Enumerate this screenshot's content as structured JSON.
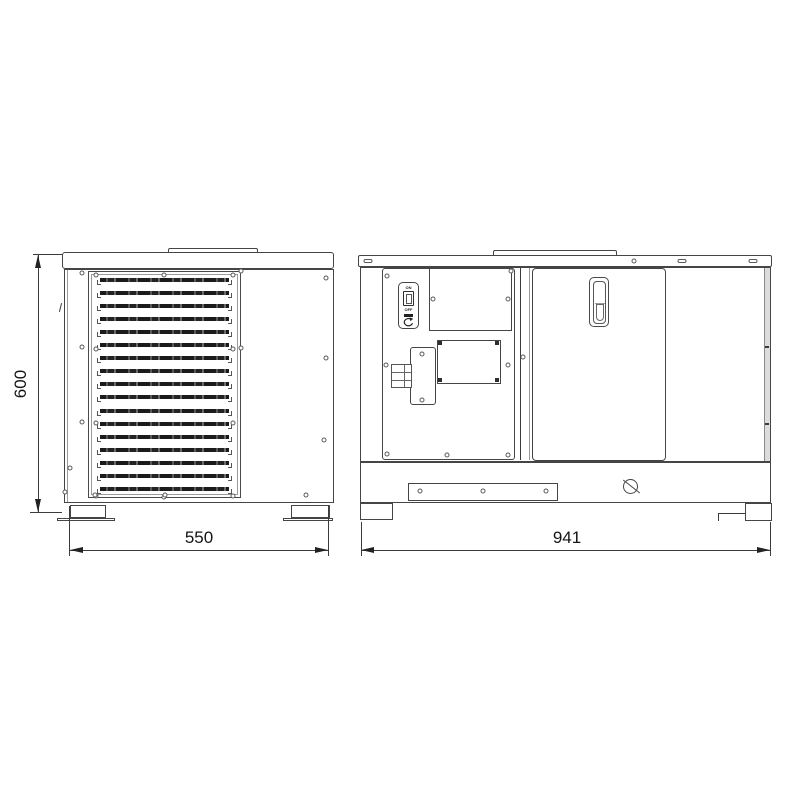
{
  "dimensions": {
    "height_label": "600",
    "front_width_label": "550",
    "side_width_label": "941"
  },
  "power_switch": {
    "on_label": "ON",
    "off_label": "OFF"
  },
  "front_view": {
    "louver_count": 17
  },
  "drawing": {
    "screws": {
      "front_panel": [
        [
          96,
          275
        ],
        [
          96,
          349
        ],
        [
          96,
          423
        ],
        [
          96,
          496
        ],
        [
          233,
          275
        ],
        [
          233,
          349
        ],
        [
          233,
          423
        ],
        [
          233,
          496
        ],
        [
          164,
          275
        ],
        [
          164,
          497
        ]
      ],
      "front_case": [
        [
          82,
          273
        ],
        [
          82,
          347
        ],
        [
          82,
          422
        ],
        [
          70,
          468
        ],
        [
          241,
          271
        ],
        [
          241,
          348
        ],
        [
          326,
          278
        ],
        [
          326,
          358
        ],
        [
          324,
          440
        ],
        [
          306,
          495
        ],
        [
          65,
          492
        ],
        [
          95,
          495
        ],
        [
          165,
          495
        ]
      ],
      "side_view": [
        [
          387,
          276
        ],
        [
          511,
          271
        ],
        [
          386,
          365
        ],
        [
          508,
          365
        ],
        [
          387,
          454
        ],
        [
          447,
          455
        ],
        [
          508,
          455
        ],
        [
          433,
          299
        ],
        [
          508,
          299
        ],
        [
          422,
          354
        ],
        [
          422,
          400
        ],
        [
          523,
          357
        ]
      ],
      "base_bracket": [
        [
          420,
          491
        ],
        [
          483,
          491
        ],
        [
          546,
          491
        ]
      ]
    },
    "corner_screws": [
      [
        440,
        343
      ],
      [
        497,
        343
      ],
      [
        440,
        380
      ],
      [
        497,
        380
      ]
    ],
    "band_slots": [
      {
        "x": 368,
        "y": 261,
        "shape": "oval"
      },
      {
        "x": 634,
        "y": 261,
        "shape": "circle"
      },
      {
        "x": 682,
        "y": 261,
        "shape": "oval"
      },
      {
        "x": 753,
        "y": 261,
        "shape": "oval"
      }
    ],
    "edge_ticks": [
      [
        765,
        346
      ],
      [
        765,
        423
      ]
    ]
  }
}
